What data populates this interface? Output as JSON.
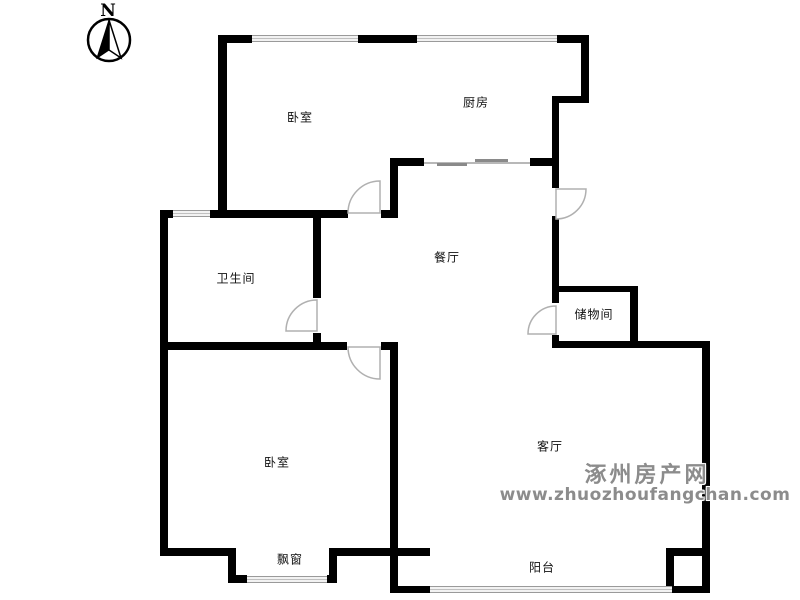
{
  "compass": {
    "label": "N"
  },
  "rooms": {
    "bedroom_top": {
      "label": "卧室"
    },
    "kitchen": {
      "label": "厨房"
    },
    "bathroom": {
      "label": "卫生间"
    },
    "dining": {
      "label": "餐厅"
    },
    "storage": {
      "label": "储物间"
    },
    "bedroom_bottom": {
      "label": "卧室"
    },
    "living": {
      "label": "客厅"
    },
    "bay_window": {
      "label": "飘窗"
    },
    "balcony": {
      "label": "阳台"
    }
  },
  "watermark": {
    "site_name": "涿州房产网",
    "site_url": "www.zhuozhoufangchan.com"
  },
  "colors": {
    "wall": "#000000",
    "window_line": "#9a9a9a",
    "door_arc": "#b0b0b0",
    "label_text": "#111111",
    "watermark_text": "#8c8c8c"
  }
}
